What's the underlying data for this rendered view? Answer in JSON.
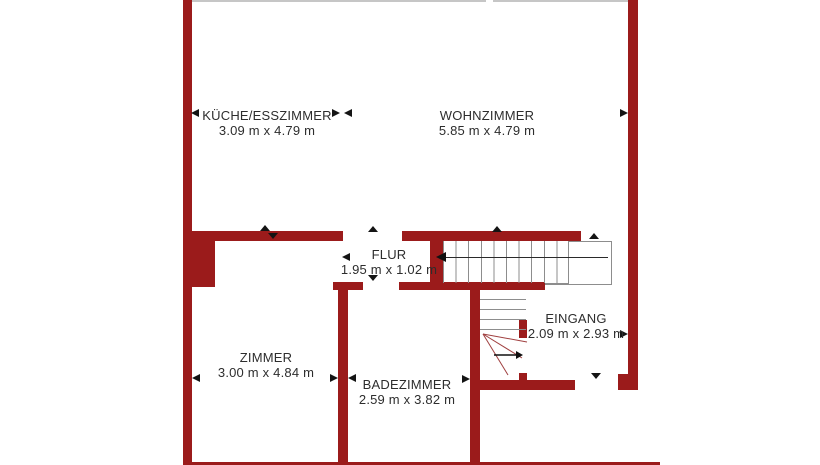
{
  "plan": {
    "title": "floor-plan",
    "rooms": [
      {
        "id": "kueche",
        "name": "KÜCHE/ESSZIMMER",
        "dims": "3.09 m x 4.79 m"
      },
      {
        "id": "wohnzimmer",
        "name": "WOHNZIMMER",
        "dims": "5.85 m x 4.79 m"
      },
      {
        "id": "flur",
        "name": "FLUR",
        "dims": "1.95 m x 1.02 m"
      },
      {
        "id": "zimmer",
        "name": "ZIMMER",
        "dims": "3.00 m x 4.84 m"
      },
      {
        "id": "badezimmer",
        "name": "BADEZIMMER",
        "dims": "2.59 m x 3.82 m"
      },
      {
        "id": "eingang",
        "name": "EINGANG",
        "dims": "2.09 m x 2.93 m"
      }
    ],
    "colors": {
      "wall": "#9b1b1b",
      "text": "#2d2d2d",
      "stair_lines": "#8d8d8d",
      "markers": "#141414",
      "background": "#ffffff"
    }
  }
}
